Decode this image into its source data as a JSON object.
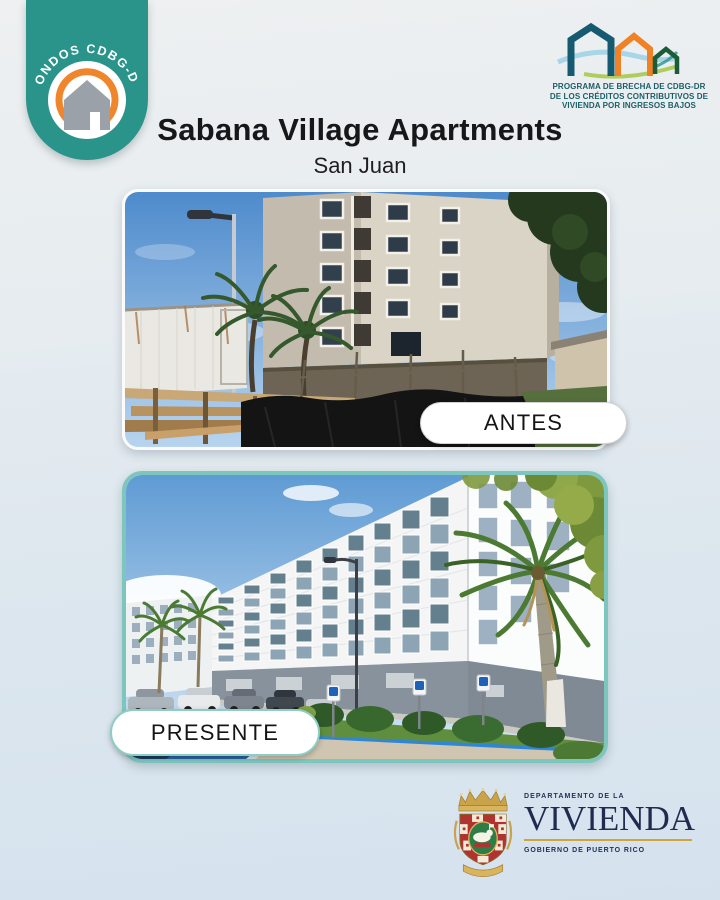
{
  "badge": {
    "label": "FONDOS CDBG-DR"
  },
  "program_logo": {
    "line1": "PROGRAMA DE BRECHA DE CDBG-DR",
    "line2": "DE LOS CRÉDITOS CONTRIBUTIVOS DE",
    "line3": "VIVIENDA POR INGRESOS BAJOS"
  },
  "header": {
    "title": "Sabana Village Apartments",
    "subtitle": "San Juan"
  },
  "photos": {
    "before_label": "ANTES",
    "after_label": "PRESENTE"
  },
  "department": {
    "line_top": "DEPARTAMENTO DE LA",
    "name": "VIVIENDA",
    "line_bottom": "GOBIERNO DE PUERTO RICO"
  },
  "colors": {
    "ribbon_teal": "#2a948b",
    "arc_orange": "#f0862c",
    "mint_border": "#7dc6be",
    "navy_text": "#1f2c4e",
    "gold_accent": "#d2a43e",
    "program_text_teal": "#1b5f66"
  }
}
